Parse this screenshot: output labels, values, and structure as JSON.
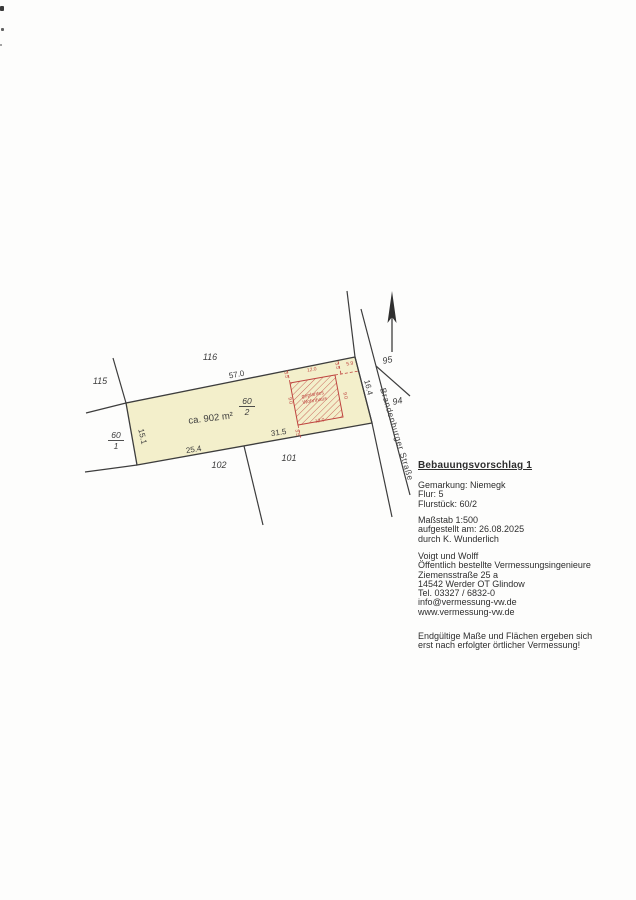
{
  "plan": {
    "colors": {
      "parcel_fill": "#f3efcb",
      "boundary_line": "#3d3d3d",
      "red": "#bf4540"
    },
    "parcel_labels": {
      "p115": "115",
      "p116": "116",
      "p102": "102",
      "p101": "101",
      "p95": "95",
      "p94": "94"
    },
    "fractions": {
      "f60_1": {
        "num": "60",
        "den": "1"
      },
      "f60_2": {
        "num": "60",
        "den": "2"
      }
    },
    "area_label": "ca. 902 m²",
    "dims": {
      "top_edge": "57.0",
      "bottom_left_edge": "25.4",
      "bottom_right_edge": "31.5",
      "left_edge": "15.1",
      "street_edge": "16.4"
    },
    "street_name": "Brandenburger Straße",
    "building": {
      "name_line1": "geplantes",
      "name_line2": "Wohnhaus",
      "width_top": "12.0",
      "width_bottom": "12.0",
      "depth_left": "9.0",
      "depth_right": "9.0",
      "setback_top_left": "3.5",
      "setback_bottom_left": "3.5",
      "setback_top_right": "3.5",
      "dist_to_street": "5.9"
    }
  },
  "info": {
    "title": "Bebauungsvorschlag 1",
    "location": {
      "gemarkung": "Gemarkung: Niemegk",
      "flur": "Flur: 5",
      "flurstueck": "Flurstück: 60/2"
    },
    "meta": {
      "massstab": "Maßstab 1:500",
      "aufgestellt": "aufgestellt am: 26.08.2025",
      "durch": "durch K. Wunderlich"
    },
    "company": {
      "name": "Voigt und Wolff",
      "role": "Öffentlich bestellte Vermessungsingenieure",
      "street": "Ziemensstraße 25 a",
      "city": "14542 Werder OT Glindow",
      "tel": "Tel. 03327 / 6832-0",
      "email": "info@vermessung-vw.de",
      "web": "www.vermessung-vw.de"
    },
    "note": {
      "line1": "Endgültige Maße und Flächen ergeben sich",
      "line2": "erst nach erfolgter örtlicher Vermessung!"
    }
  }
}
